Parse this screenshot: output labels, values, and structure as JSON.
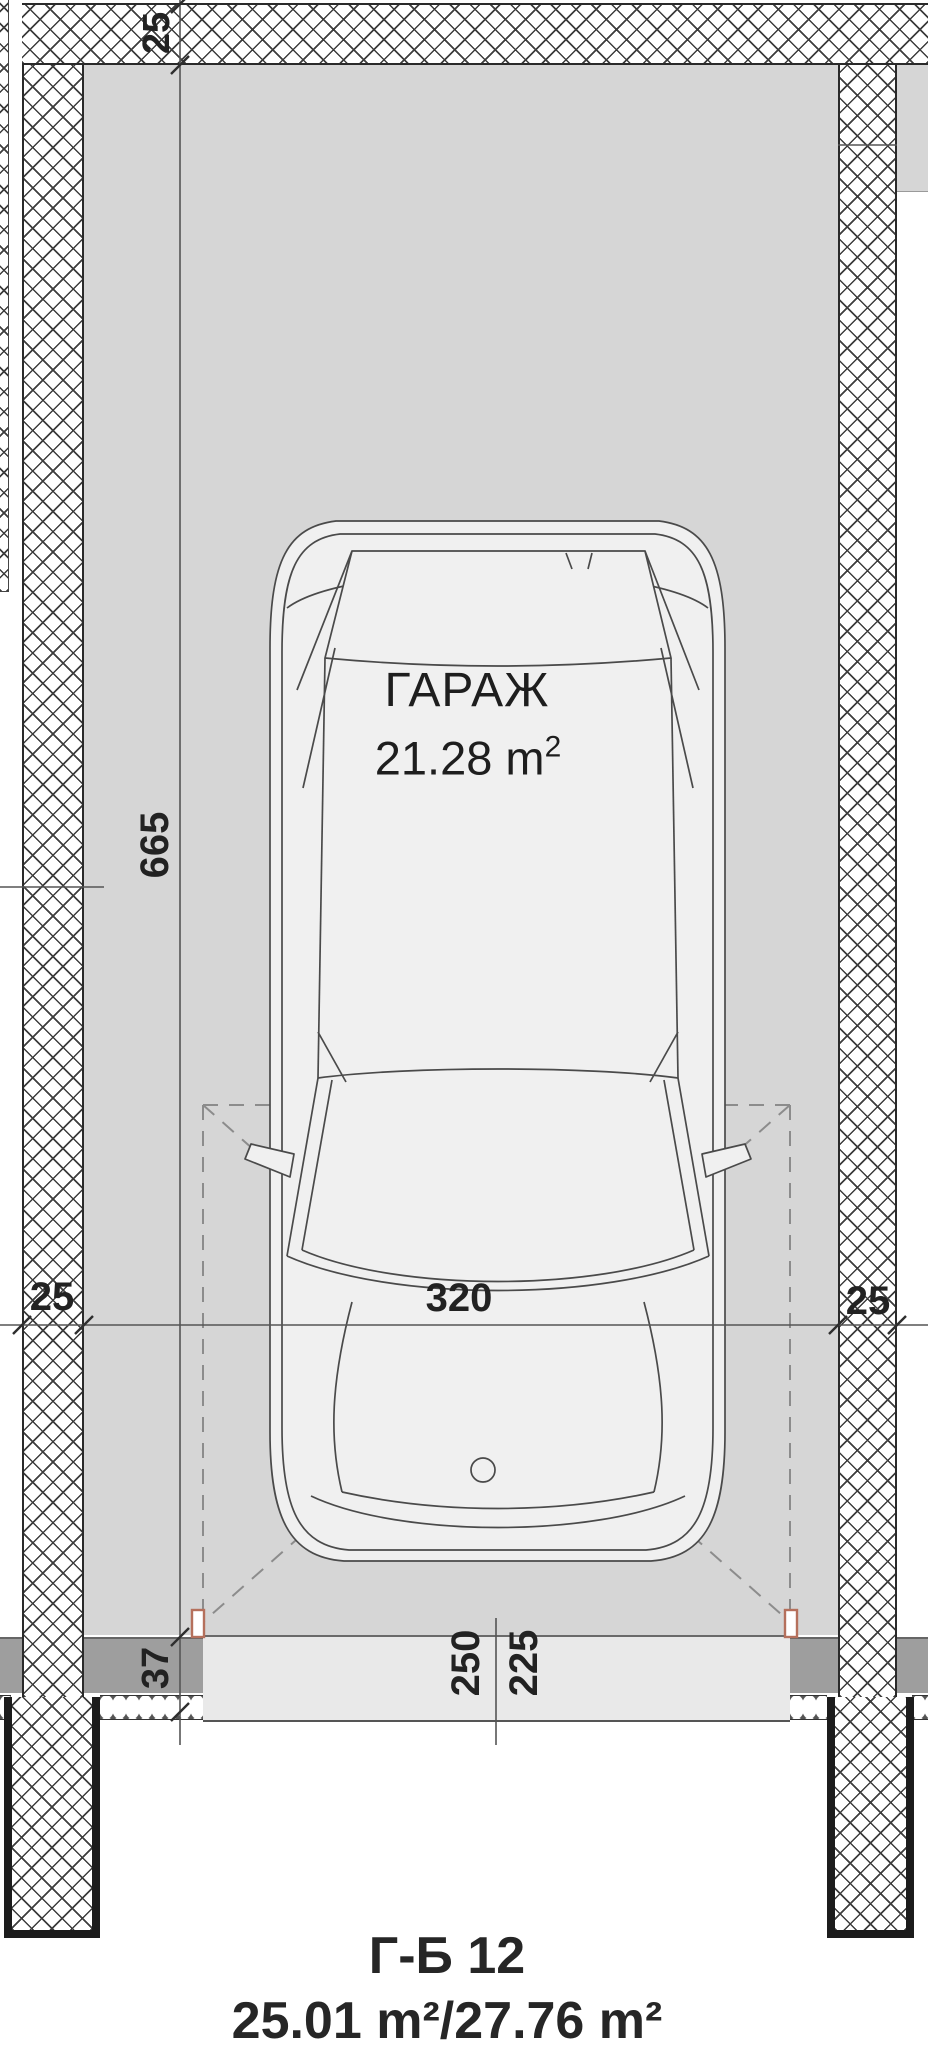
{
  "labels": {
    "room_name": "ГАРАЖ",
    "room_area_main": "21.28 m",
    "room_area_sup": "2"
  },
  "dimensions": {
    "top_wall_thickness": "25",
    "interior_length": "665",
    "interior_width": "320",
    "left_wall_thickness": "25",
    "right_wall_thickness": "25",
    "threshold_depth": "37",
    "door_opening": "250",
    "door_clear_opening": "225"
  },
  "title": {
    "unit_code": "Г-Б 12",
    "areas": "25.01 m²/27.76 m²"
  },
  "colors": {
    "door_frame_accent": "#b5705c",
    "floor_gray": "#d6d6d6",
    "car_fill": "#f0f0f0"
  }
}
